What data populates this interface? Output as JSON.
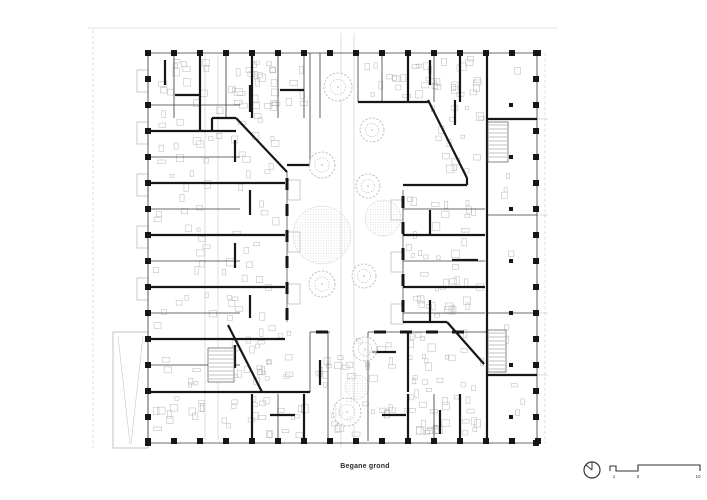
{
  "meta": {
    "caption": "Begane grond"
  },
  "scalebar": {
    "labels": [
      "1",
      "5",
      "10"
    ]
  },
  "colors": {
    "ink": "#161616",
    "mid": "#3a3a3a",
    "faint": "#c2c2c2",
    "furniture": "#b5b5b5",
    "tree": "#b0b0b0",
    "ground_dot": "#c9c9c9",
    "paper": "#ffffff"
  },
  "plan": {
    "column_rows": [
      {
        "axis": "x",
        "fixed": 53,
        "from": 148,
        "to": 538,
        "step": 26,
        "size": 6
      },
      {
        "axis": "x",
        "fixed": 441,
        "from": 148,
        "to": 538,
        "step": 26,
        "size": 6
      },
      {
        "axis": "y",
        "fixed": 148,
        "from": 53,
        "to": 444,
        "step": 26,
        "size": 6
      },
      {
        "axis": "y",
        "fixed": 536,
        "from": 53,
        "to": 444,
        "step": 26,
        "size": 6
      },
      {
        "axis": "y",
        "fixed": 511,
        "from": 105,
        "to": 420,
        "step": 52,
        "size": 4
      }
    ],
    "walls_thick": [
      [
        148,
        131,
        212,
        131
      ],
      [
        212,
        118,
        212,
        131
      ],
      [
        212,
        118,
        236,
        118
      ],
      [
        236,
        118,
        287,
        172
      ],
      [
        287,
        165,
        310,
        165
      ],
      [
        358,
        102,
        428,
        102
      ],
      [
        428,
        100,
        467,
        178
      ],
      [
        403,
        185,
        467,
        185
      ],
      [
        467,
        178,
        467,
        185
      ],
      [
        403,
        235,
        485,
        235
      ],
      [
        403,
        287,
        485,
        287
      ],
      [
        403,
        322,
        447,
        322
      ],
      [
        447,
        322,
        484,
        364
      ],
      [
        228,
        325,
        262,
        392
      ],
      [
        148,
        392,
        310,
        392
      ],
      [
        200,
        53,
        200,
        131
      ],
      [
        252,
        53,
        252,
        118
      ],
      [
        408,
        53,
        408,
        102
      ],
      [
        460,
        53,
        460,
        102
      ],
      [
        148,
        183,
        285,
        183
      ],
      [
        148,
        235,
        285,
        235
      ],
      [
        148,
        287,
        285,
        287
      ],
      [
        148,
        339,
        285,
        339
      ],
      [
        212,
        131,
        236,
        131
      ],
      [
        252,
        394,
        252,
        441
      ],
      [
        304,
        394,
        304,
        441
      ],
      [
        408,
        394,
        408,
        441
      ],
      [
        460,
        394,
        460,
        441
      ],
      [
        487,
        53,
        487,
        443
      ],
      [
        487,
        119,
        537,
        119
      ],
      [
        487,
        375,
        537,
        375
      ],
      [
        408,
        332,
        408,
        392
      ],
      [
        250,
        85,
        250,
        112
      ],
      [
        235,
        140,
        235,
        162
      ],
      [
        250,
        190,
        250,
        215
      ],
      [
        235,
        243,
        235,
        268
      ],
      [
        250,
        295,
        250,
        318
      ],
      [
        235,
        345,
        235,
        368
      ],
      [
        175,
        95,
        200,
        95
      ],
      [
        280,
        90,
        304,
        90
      ],
      [
        430,
        60,
        430,
        85
      ],
      [
        455,
        100,
        455,
        125
      ],
      [
        430,
        210,
        430,
        235
      ],
      [
        452,
        260,
        478,
        260
      ],
      [
        430,
        300,
        430,
        322
      ],
      [
        270,
        415,
        295,
        415
      ],
      [
        382,
        415,
        406,
        415
      ],
      [
        440,
        410,
        440,
        434
      ],
      [
        320,
        360,
        320,
        385
      ],
      [
        372,
        352,
        396,
        352
      ],
      [
        165,
        60,
        165,
        85
      ]
    ],
    "walls_thin": [
      [
        148,
        53,
        537,
        53
      ],
      [
        148,
        443,
        537,
        443
      ],
      [
        148,
        53,
        148,
        443
      ],
      [
        537,
        53,
        537,
        443
      ],
      [
        310,
        53,
        310,
        165
      ],
      [
        320,
        53,
        320,
        118
      ],
      [
        358,
        53,
        358,
        102
      ],
      [
        328,
        332,
        328,
        441
      ],
      [
        368,
        332,
        368,
        441
      ],
      [
        310,
        332,
        310,
        392
      ],
      [
        148,
        105,
        240,
        105
      ],
      [
        148,
        157,
        240,
        157
      ],
      [
        148,
        209,
        240,
        209
      ],
      [
        148,
        261,
        240,
        261
      ],
      [
        148,
        313,
        240,
        313
      ],
      [
        148,
        365,
        240,
        365
      ],
      [
        174,
        53,
        174,
        118
      ],
      [
        226,
        53,
        226,
        118
      ],
      [
        278,
        53,
        278,
        118
      ],
      [
        304,
        53,
        304,
        118
      ],
      [
        382,
        53,
        382,
        102
      ],
      [
        434,
        53,
        434,
        102
      ],
      [
        403,
        209,
        485,
        209
      ],
      [
        403,
        261,
        485,
        261
      ],
      [
        403,
        313,
        485,
        313
      ],
      [
        278,
        394,
        278,
        441
      ],
      [
        434,
        394,
        434,
        441
      ],
      [
        487,
        215,
        537,
        215
      ],
      [
        487,
        313,
        537,
        313
      ]
    ],
    "walls_faint": [
      [
        205,
        55,
        205,
        440
      ],
      [
        218,
        55,
        218,
        440
      ],
      [
        341,
        33,
        341,
        447
      ],
      [
        354,
        33,
        354,
        447
      ],
      [
        88,
        28,
        557,
        28
      ],
      [
        537,
        119,
        548,
        119
      ],
      [
        537,
        215,
        548,
        215
      ],
      [
        537,
        313,
        548,
        313
      ],
      [
        537,
        375,
        548,
        375
      ],
      [
        118,
        336,
        130,
        444
      ],
      [
        143,
        336,
        131,
        444
      ]
    ],
    "walls_dashed": [
      [
        93,
        30,
        93,
        448
      ],
      [
        545,
        53,
        545,
        443
      ]
    ],
    "studded_walls": [
      [
        287,
        172,
        287,
        322
      ],
      [
        403,
        190,
        403,
        322
      ],
      [
        368,
        332,
        487,
        332
      ],
      [
        310,
        332,
        330,
        332
      ]
    ],
    "balconies": [
      [
        137,
        70,
        11,
        22
      ],
      [
        137,
        122,
        11,
        22
      ],
      [
        137,
        174,
        11,
        22
      ],
      [
        137,
        226,
        11,
        22
      ],
      [
        137,
        278,
        11,
        22
      ],
      [
        288,
        180,
        12,
        20
      ],
      [
        288,
        232,
        12,
        20
      ],
      [
        288,
        284,
        12,
        20
      ],
      [
        391,
        200,
        12,
        20
      ],
      [
        391,
        252,
        12,
        20
      ],
      [
        391,
        304,
        12,
        20
      ]
    ],
    "stair_blocks": [
      [
        488,
        122,
        20,
        40
      ],
      [
        488,
        330,
        18,
        42
      ],
      [
        208,
        348,
        26,
        34
      ]
    ],
    "ramp": {
      "rect": [
        113,
        332,
        35,
        116
      ]
    },
    "trees": [
      [
        338,
        87,
        14
      ],
      [
        372,
        130,
        12
      ],
      [
        322,
        165,
        13
      ],
      [
        368,
        186,
        12
      ],
      [
        322,
        284,
        13
      ],
      [
        364,
        276,
        12
      ],
      [
        365,
        349,
        12
      ],
      [
        347,
        412,
        14
      ]
    ],
    "ground_circles": [
      [
        322,
        235,
        29
      ],
      [
        383,
        218,
        18
      ],
      [
        357,
        387,
        12
      ]
    ],
    "furniture_zones": [
      [
        152,
        58,
        130,
        330,
        110
      ],
      [
        236,
        58,
        72,
        55,
        16
      ],
      [
        362,
        56,
        123,
        44,
        34
      ],
      [
        430,
        104,
        55,
        72,
        16
      ],
      [
        406,
        188,
        78,
        132,
        40
      ],
      [
        406,
        326,
        78,
        112,
        30
      ],
      [
        312,
        336,
        88,
        52,
        22
      ],
      [
        230,
        330,
        76,
        58,
        16
      ],
      [
        217,
        396,
        268,
        44,
        55
      ],
      [
        490,
        58,
        44,
        378,
        10
      ],
      [
        152,
        396,
        60,
        44,
        12
      ]
    ]
  }
}
